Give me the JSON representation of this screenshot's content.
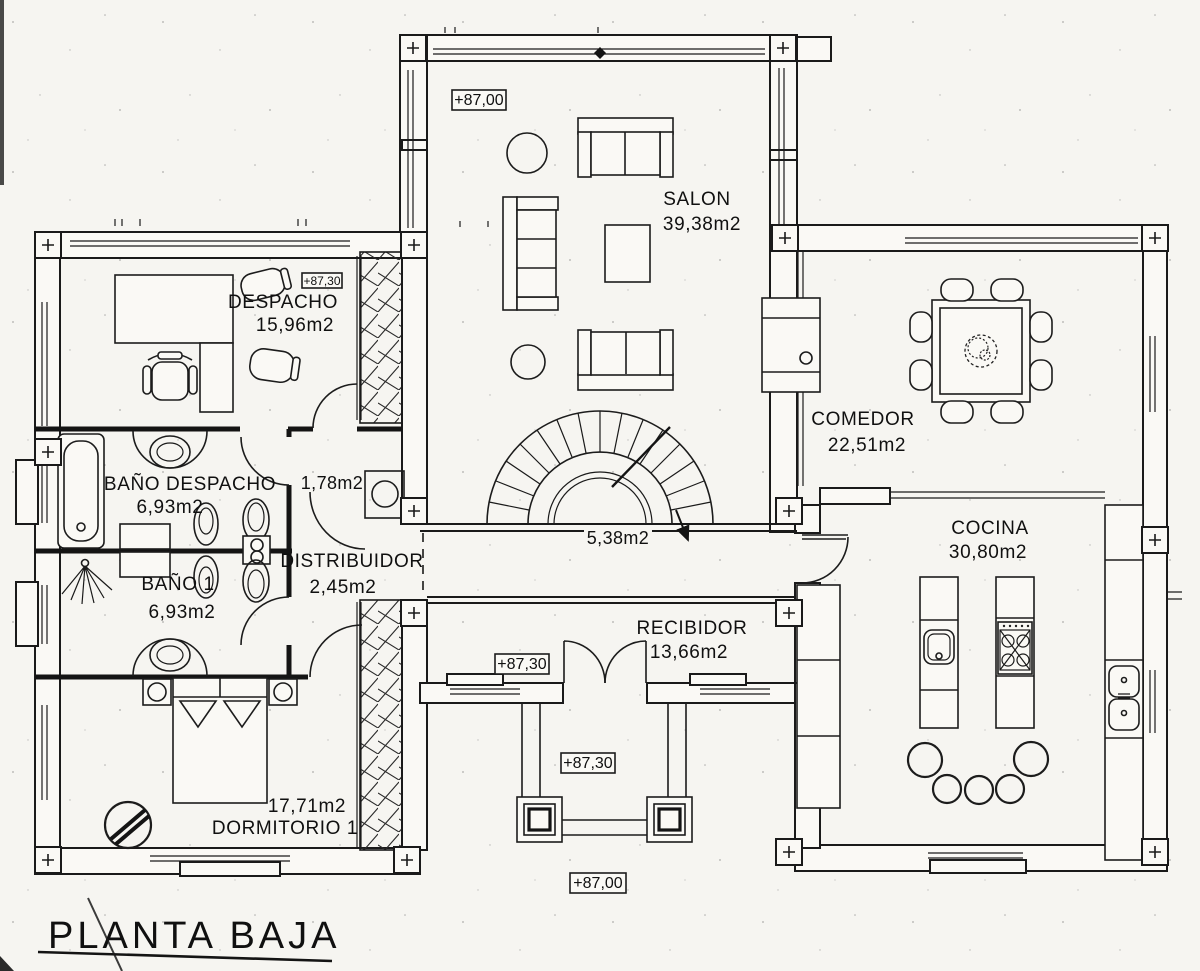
{
  "title": "PLANTA BAJA",
  "rooms": {
    "salon": {
      "name": "SALON",
      "area": "39,38m2"
    },
    "despacho": {
      "name": "DESPACHO",
      "area": "15,96m2"
    },
    "bano_despacho": {
      "name": "BAÑO DESPACHO",
      "area": "6,93m2"
    },
    "bano1": {
      "name": "BAÑO 1",
      "area": "6,93m2"
    },
    "distribuidor": {
      "name": "DISTRIBUIDOR",
      "area": "2,45m2"
    },
    "armario": {
      "area": "1,78m2"
    },
    "escalera": {
      "area": "5,38m2"
    },
    "comedor": {
      "name": "COMEDOR",
      "area": "22,51m2"
    },
    "cocina": {
      "name": "COCINA",
      "area": "30,80m2"
    },
    "recibidor": {
      "name": "RECIBIDOR",
      "area": "13,66m2"
    },
    "dormitorio1": {
      "name": "DORMITORIO 1",
      "area": "17,71m2"
    }
  },
  "elevations": {
    "salon": "+87,00",
    "despacho": "+87,30",
    "entrada": "+87,30",
    "porche": "+87,30",
    "exterior": "+87,00"
  },
  "colors": {
    "ink": "#1a1a1a",
    "paper": "#f6f5f1"
  }
}
